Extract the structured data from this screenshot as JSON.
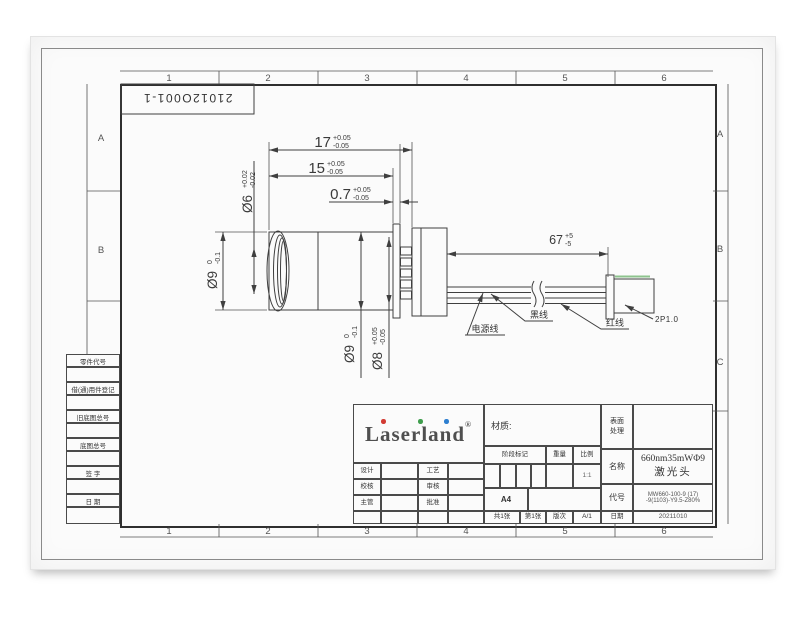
{
  "sheet": {
    "drawing_no": "21012O001-1",
    "zones_top": [
      "1",
      "2",
      "3",
      "4",
      "5",
      "6"
    ],
    "zones_bottom": [
      "1",
      "2",
      "3",
      "4",
      "5",
      "6"
    ],
    "zones_left": [
      "A",
      "B"
    ],
    "zones_right": [
      "A",
      "B",
      "C"
    ]
  },
  "margin_fields": [
    "零件代号",
    "借(通)用件登记",
    "旧底图总号",
    "底图总号",
    "签 字",
    "日 期"
  ],
  "dimensions": {
    "len17": {
      "value": "17",
      "tol_plus": "+0.05",
      "tol_minus": "-0.05"
    },
    "len15": {
      "value": "15",
      "tol_plus": "+0.05",
      "tol_minus": "-0.05"
    },
    "len07": {
      "value": "0.7",
      "tol_plus": "+0.05",
      "tol_minus": "-0.05"
    },
    "dia6": {
      "value": "Ø6",
      "tol_plus": "+0.02",
      "tol_minus": "-0.02"
    },
    "dia9_front": {
      "value": "Ø9",
      "tol_plus": "0",
      "tol_minus": "-0.1"
    },
    "dia9_body": {
      "value": "Ø9",
      "tol_plus": "0",
      "tol_minus": "-0.1"
    },
    "dia8": {
      "value": "Ø8",
      "tol_plus": "+0.05",
      "tol_minus": "-0.05"
    },
    "len67": {
      "value": "67",
      "tol_plus": "+5",
      "tol_minus": "-5"
    }
  },
  "callouts": {
    "power_wire": "电源线",
    "black_wire": "黑线",
    "red_wire": "红线",
    "connector": "2P1.0"
  },
  "title_block": {
    "logo_text": "Laserland",
    "logo_reg": "®",
    "material_label": "材质:",
    "stage_label": "阶段标记",
    "weight_label": "重量",
    "scale_label": "比例",
    "scale_value": "1:1",
    "sheet_size": "A4",
    "sheets_total": "共1张",
    "sheet_no": "第1张",
    "rev_label": "版次",
    "rev_value": "A/1",
    "surface_label": "表面处理",
    "name_label": "名称",
    "name_line1": "660nm35mWΦ9",
    "name_line2": "激光头",
    "code_label": "代号",
    "code_line1": "MW660-100-9 (17)",
    "code_line2": "-9(1103)-Y9.5-Z80%",
    "date_label": "日期",
    "date_value": "20211010",
    "sign_rows": [
      {
        "left": "设计",
        "right": "工艺"
      },
      {
        "left": "校核",
        "right": "审核"
      },
      {
        "left": "主管",
        "right": "批准"
      }
    ]
  },
  "colors": {
    "line": "#3f3f3f",
    "logo_gray": "#4f4f4f",
    "dot_red": "#d23b33",
    "dot_green": "#3f9e4d",
    "dot_blue": "#2e7fd0",
    "paper": "#fbfbfb"
  }
}
